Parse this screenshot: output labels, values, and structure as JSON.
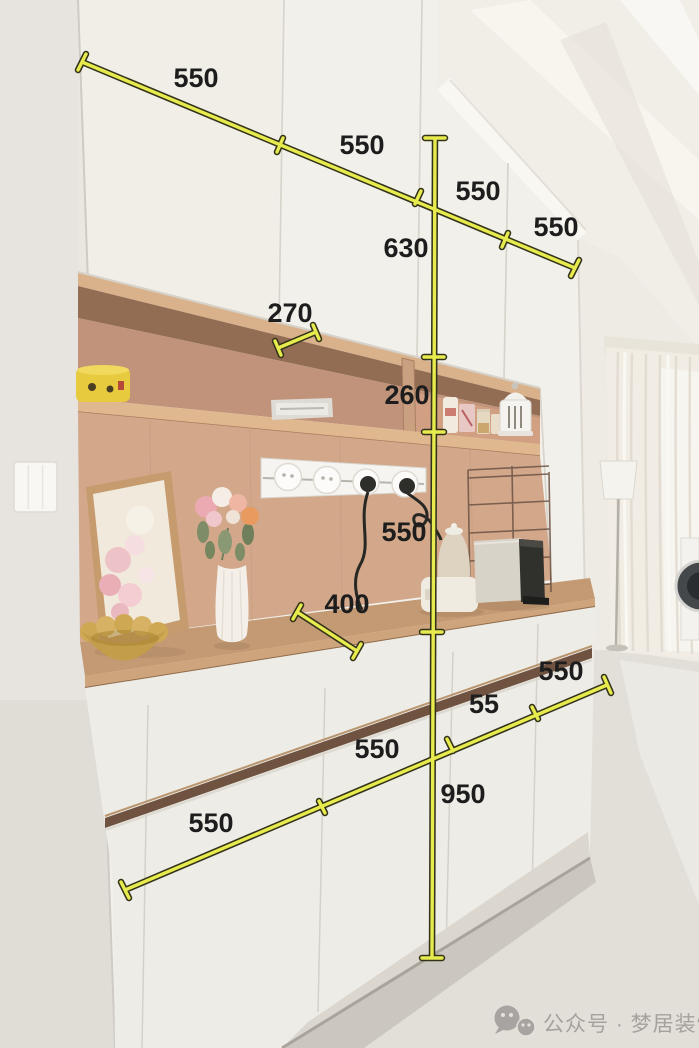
{
  "dimensions": {
    "top_widths": [
      "550",
      "550",
      "550",
      "550"
    ],
    "upper_cabinet_height": "630",
    "niche_top_depth": "270",
    "niche_shelf_gap": "260",
    "shelf_to_counter": "550",
    "counter_depth": "400",
    "base_widths": [
      "550",
      "550",
      "55",
      "550"
    ],
    "base_height": "950"
  },
  "watermark": {
    "icon": "wechat-icon",
    "text": "公众号 · 梦居装饰"
  },
  "style": {
    "dimension_line_color": "#e8eb4e",
    "dimension_outline_color": "#33331a",
    "label_color": "#1d1d1d",
    "watermark_color": "#a4a19e"
  }
}
